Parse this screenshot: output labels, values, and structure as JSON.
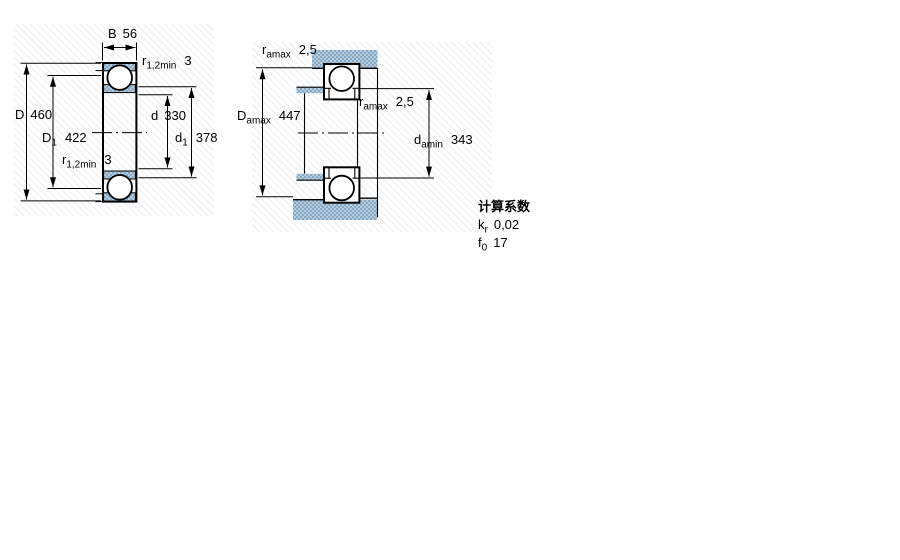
{
  "colors": {
    "line": "#000000",
    "hatch_base": "#b4cdde",
    "hatch_dot": "#86a8c2",
    "faint_hatch_line": "#e9edf2",
    "background": "#ffffff"
  },
  "left_drawing": {
    "description": "bearing cross-section with boundary dimensions",
    "dims": {
      "B": {
        "label": "B",
        "value": "56"
      },
      "r12_top": {
        "base": "r",
        "sub": "1,2min",
        "value": "3"
      },
      "D": {
        "label": "D",
        "value": "460"
      },
      "D1": {
        "base": "D",
        "sub": "1",
        "value": "422"
      },
      "r12_bottom": {
        "base": "r",
        "sub": "1,2min",
        "value": "3"
      },
      "d": {
        "label": "d",
        "value": "330"
      },
      "d1": {
        "base": "d",
        "sub": "1",
        "value": "378"
      }
    }
  },
  "right_drawing": {
    "description": "mounted bearing cross-section with abutment dimensions",
    "dims": {
      "ra_top": {
        "base": "r",
        "sub": "amax",
        "value": "2,5"
      },
      "Da": {
        "base": "D",
        "sub": "amax",
        "value": "447"
      },
      "ra_mid": {
        "base": "r",
        "sub": "amax",
        "value": "2,5"
      },
      "da": {
        "base": "d",
        "sub": "amin",
        "value": "343"
      }
    }
  },
  "calculation_factors": {
    "title": "计算系数",
    "rows": [
      {
        "base": "k",
        "sub": "r",
        "value": "0,02"
      },
      {
        "base": "f",
        "sub": "0",
        "value": "17"
      }
    ]
  }
}
